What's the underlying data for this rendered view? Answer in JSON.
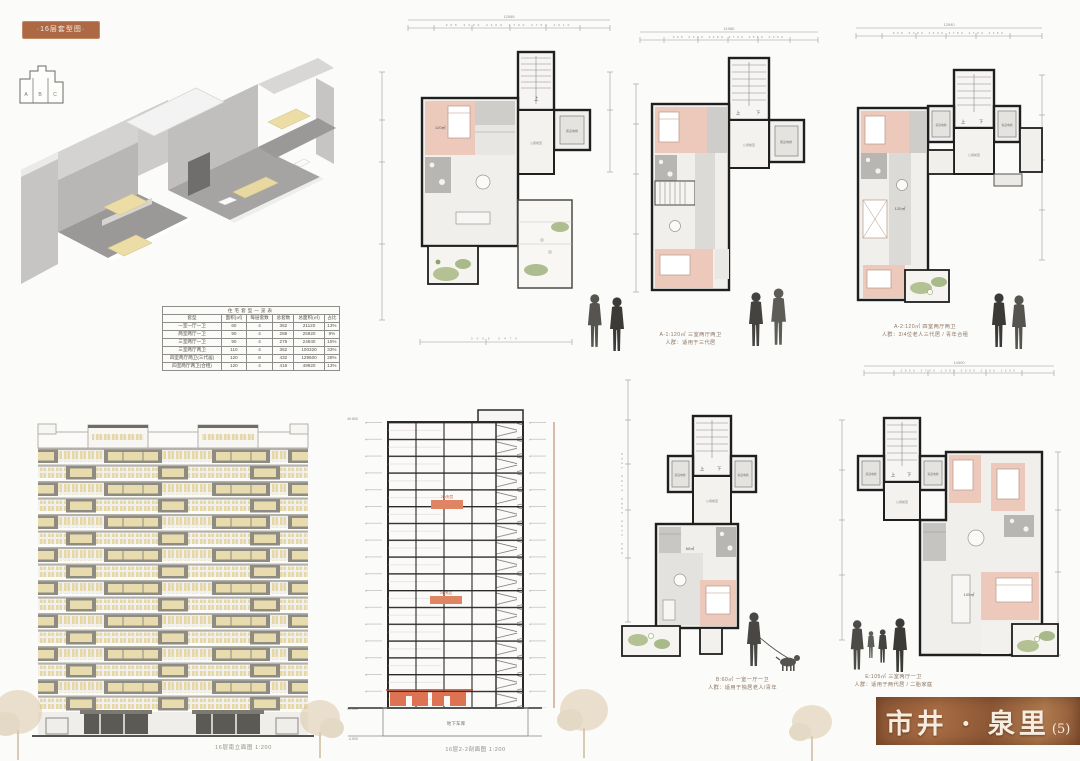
{
  "board": {
    "tag_label": "·16层套型图·",
    "title": "市井 · 泉里",
    "title_no": "(5)",
    "elevation_caption": "16层南立面图  1:200",
    "section_caption": "16层2-2剖面图  1:200"
  },
  "key_plan": {
    "a": "A",
    "b": "B",
    "c": "C"
  },
  "unit_table": {
    "title": "住宅套型一览表",
    "headers": [
      "套型",
      "面积(㎡)",
      "每层套数",
      "总套数",
      "总面积(㎡)",
      "占比"
    ],
    "rows": [
      [
        "一室一厅一卫",
        "60",
        "4",
        "352",
        "21120",
        "13%"
      ],
      [
        "两室两厅一卫",
        "90",
        "4",
        "288",
        "25920",
        "8%"
      ],
      [
        "三室两厅一卫",
        "90",
        "4",
        "276",
        "24840",
        "15%"
      ],
      [
        "三室两厅两卫",
        "110",
        "4",
        "352",
        "100320",
        "33%"
      ],
      [
        "四室两厅两卫(三代居)",
        "120",
        "8",
        "432",
        "129600",
        "28%"
      ],
      [
        "四室两厅两卫(合租)",
        "120",
        "4",
        "416",
        "49920",
        "13%"
      ]
    ]
  },
  "plan_labels": {
    "up": "上",
    "down": "下",
    "elev_freight": "货运电梯",
    "elev_passenger": "客运电梯",
    "lobby": "公用前室"
  },
  "plans": {
    "a1": {
      "dim_total": "12065",
      "dims_top": "905 3300 2400 2700 2750 2010",
      "dims_bottom": "3005 6470",
      "area": "120㎡"
    },
    "a2": {
      "dim_total": "11060",
      "dims_top": "905 3300 2400 2700 2550 2050"
    },
    "a3": {
      "dim_total": "12940",
      "dims_top": "905 3300 2400 2700 2700 2250",
      "area": "120㎡"
    },
    "b": {
      "dims_left": "850 3150 2400 2700 7200",
      "area": "60㎡"
    },
    "e": {
      "dim_total": "14300",
      "dims_top": "2850 2700 1500 3050 2700 1500",
      "area": "105㎡"
    }
  },
  "captions": {
    "a1": {
      "line1": "A-1:120㎡  三室两厅两卫",
      "line2": "人群：适用于三代居"
    },
    "a2": {
      "line1": "A-2:120㎡  四室两厅两卫",
      "line2": "人群：3/4位老人三代居 / 青年合租"
    },
    "b": {
      "line1": "B:60㎡  一室一厅一卫",
      "line2": "人群：适用于独居老人/青年"
    },
    "e": {
      "line1": "E:105㎡  三室两厅一卫",
      "line2": "人群：适用于两代居 / 二胎家庭"
    }
  },
  "section_labels": {
    "basement": "地下车库",
    "mezzanine1": "2m夹层",
    "mezzanine2": "2m夹层",
    "level_top": "49.800",
    "level_zero": "±0.000",
    "level_base": "-4.500"
  },
  "colors": {
    "accent": "#ad6844",
    "title_bg": "#96613c",
    "room_pink": "#ecc9bb",
    "green": "#b3c193",
    "window_yellow": "#e6d7a6",
    "frame_gray": "#8d8b82",
    "accent_red": "#d96d4f"
  }
}
